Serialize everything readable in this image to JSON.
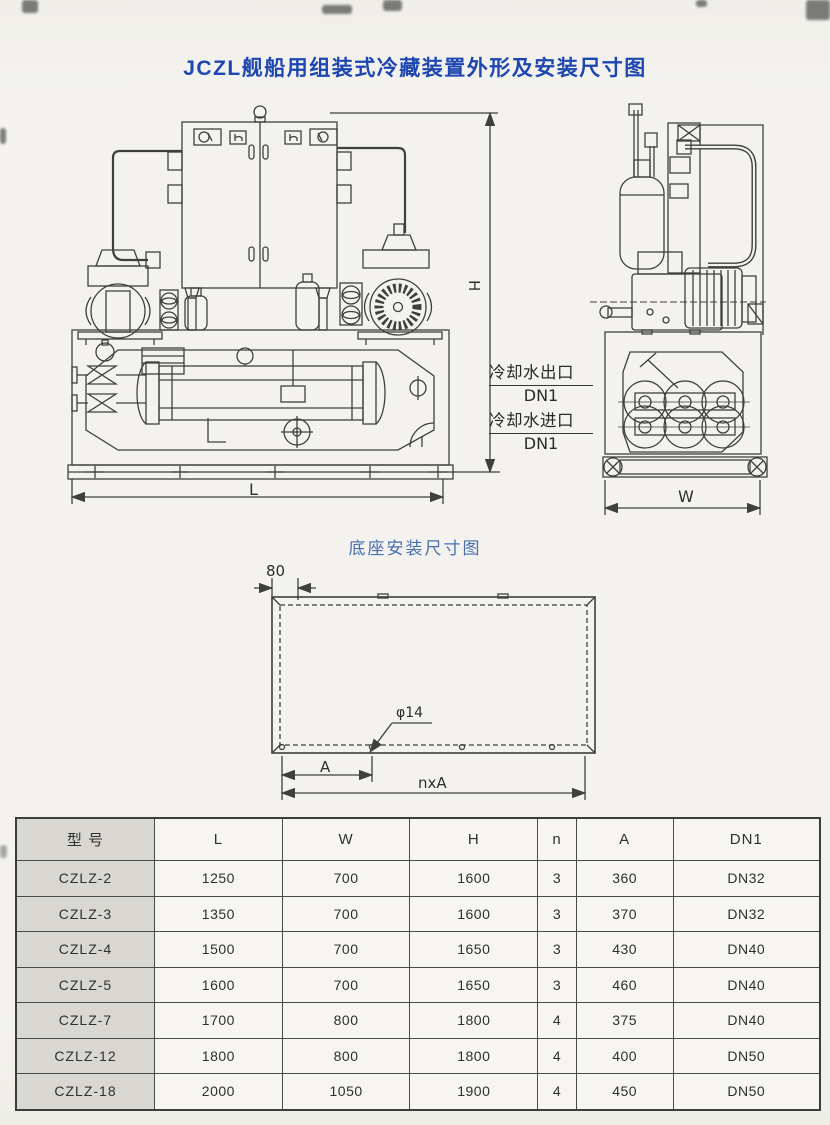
{
  "page": {
    "title": "JCZL舰船用组装式冷藏装置外形及安装尺寸图",
    "base_diagram_title": "底座安装尺寸图"
  },
  "front_view": {
    "dim_height": "H",
    "dim_length": "L"
  },
  "side_view": {
    "dim_width": "W"
  },
  "pipe_labels": {
    "outlet": "冷却水出口",
    "outlet_dn": "DN1",
    "inlet": "冷却水进口",
    "inlet_dn": "DN1"
  },
  "base_diagram": {
    "dim_edge": "80",
    "hole_diameter": "φ14",
    "dim_pitch": "A",
    "dim_total": "nxA"
  },
  "table": {
    "headers": [
      "型 号",
      "L",
      "W",
      "H",
      "n",
      "A",
      "DN1"
    ],
    "rows": [
      [
        "CZLZ-2",
        "1250",
        "700",
        "1600",
        "3",
        "360",
        "DN32"
      ],
      [
        "CZLZ-3",
        "1350",
        "700",
        "1600",
        "3",
        "370",
        "DN32"
      ],
      [
        "CZLZ-4",
        "1500",
        "700",
        "1650",
        "3",
        "430",
        "DN40"
      ],
      [
        "CZLZ-5",
        "1600",
        "700",
        "1650",
        "3",
        "460",
        "DN40"
      ],
      [
        "CZLZ-7",
        "1700",
        "800",
        "1800",
        "4",
        "375",
        "DN40"
      ],
      [
        "CZLZ-12",
        "1800",
        "800",
        "1800",
        "4",
        "400",
        "DN50"
      ],
      [
        "CZLZ-18",
        "2000",
        "1050",
        "1900",
        "4",
        "450",
        "DN50"
      ]
    ]
  },
  "colors": {
    "title_blue": "#1d46b0",
    "subtitle_blue": "#4a6fae",
    "line": "#3f3f3f",
    "table_shade": "#d8d7d1",
    "paper": "#f2f1ec"
  }
}
